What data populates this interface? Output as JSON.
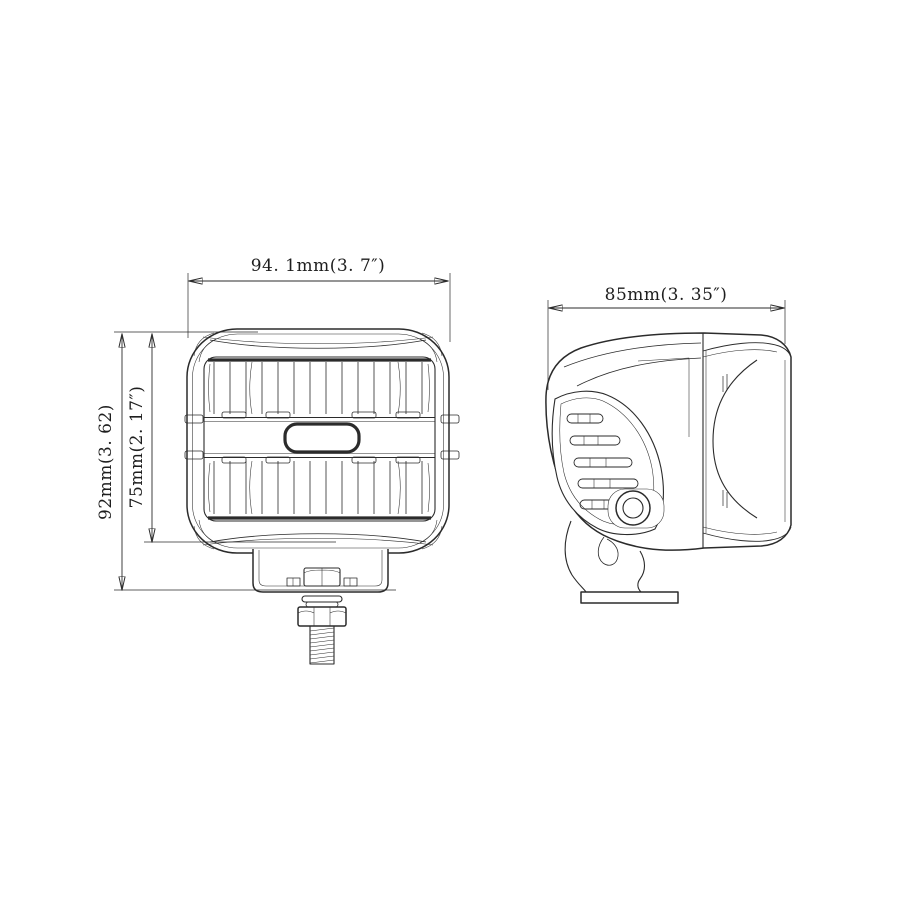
{
  "page": {
    "background_color": "#ffffff",
    "line_color": "#2b2b2b"
  },
  "dimensions": {
    "front_width": "94. 1mm(3. 7″)",
    "front_height_outer": "92mm(3. 62)",
    "front_height_inner": "75mm(2. 17″)",
    "side_width": "85mm(3. 35″)"
  }
}
